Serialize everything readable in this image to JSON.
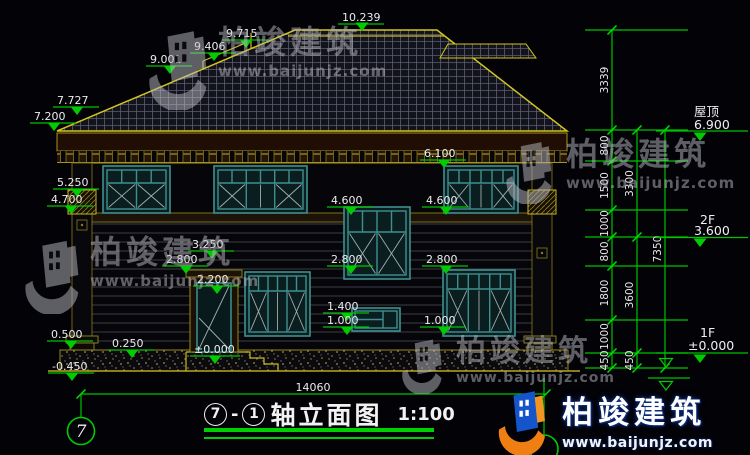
{
  "watermarks": {
    "brand": "柏竣建筑",
    "url": "www.baijunjz.com"
  },
  "brand_footer": {
    "brand": "柏竣建筑",
    "url": "www.baijunjz.com"
  },
  "title_block": {
    "axis_start": "7",
    "separator": "-",
    "axis_end": "1",
    "name": "轴立面图",
    "scale": "1:100"
  },
  "axis_bubbles": {
    "left": "7"
  },
  "floor_levels": {
    "roof_label": "屋顶",
    "roof_value": "6.900",
    "f2_label": "2F",
    "f2_value": "3.600",
    "f1_label": "1F",
    "f1_value": "±0.000"
  },
  "elevation_marks": {
    "peak": "10.239",
    "m9715": "9.715",
    "m9406": "9.406",
    "m9001": "9.001",
    "m7727": "7.727",
    "m7200": "7.200",
    "m6100": "6.100",
    "m5250": "5.250",
    "m4700": "4.700",
    "m4600_left": "4.600",
    "m4600_right": "4.600",
    "m3250": "3.250",
    "m2800_door": "2.800",
    "m2800_mid": "2.800",
    "m2800_right": "2.800",
    "m2200": "2.200",
    "m1400": "1.400",
    "m1000_mid": "1.000",
    "m1000_right": "1.000",
    "m0500": "0.500",
    "m0250": "0.250",
    "m0000": "±0.000",
    "m_neg0450": "-0.450"
  },
  "dimensions": {
    "right_inner": [
      "3339",
      "800",
      "1500",
      "1000",
      "800",
      "1800",
      "1000",
      "450"
    ],
    "right_mid": [
      "3300",
      "3600",
      "450"
    ],
    "right_outer": "7350",
    "bottom_width": "14060"
  }
}
